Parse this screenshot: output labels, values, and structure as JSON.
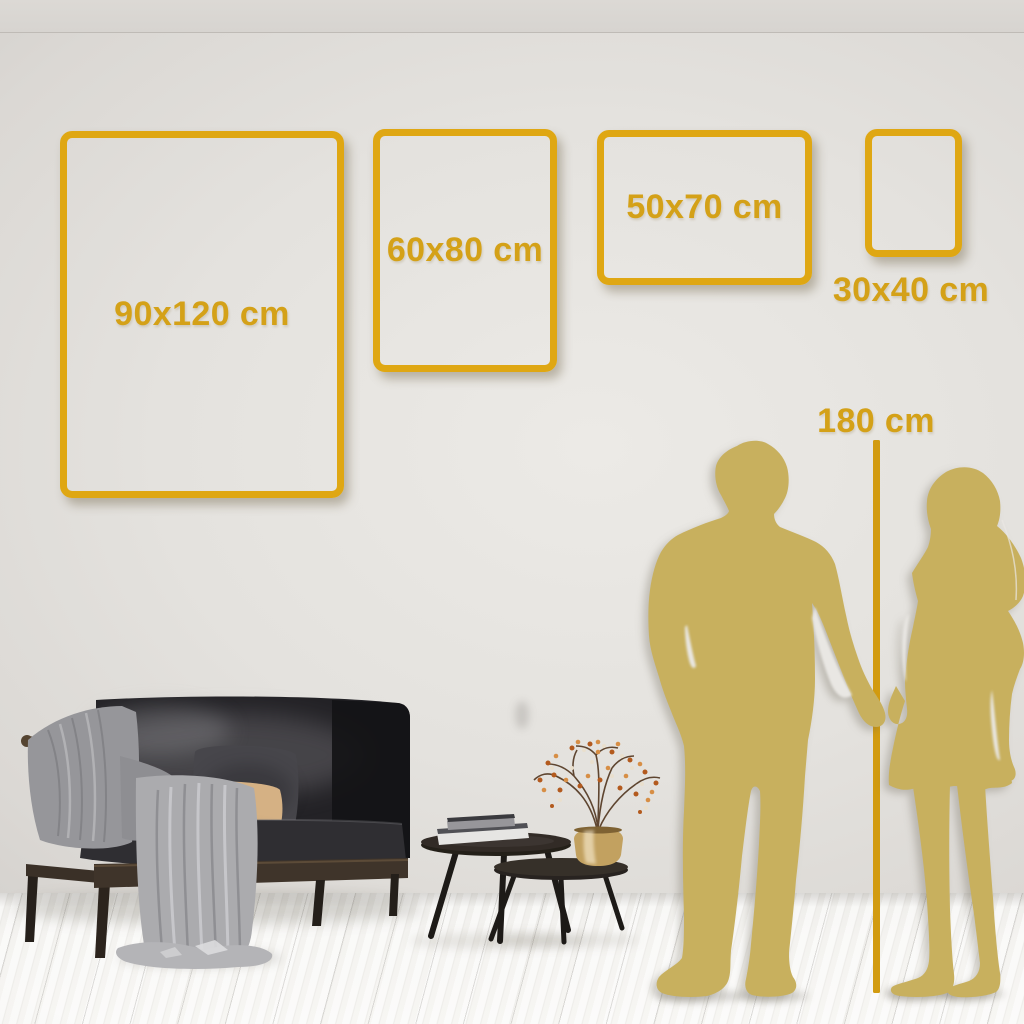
{
  "size_guide": {
    "unit": "cm",
    "frames": [
      {
        "label": "90x120 cm",
        "width_cm": 90,
        "height_cm": 120,
        "orientation_shown": "portrait"
      },
      {
        "label": "60x80 cm",
        "width_cm": 60,
        "height_cm": 80,
        "orientation_shown": "portrait"
      },
      {
        "label": "50x70 cm",
        "width_cm": 50,
        "height_cm": 70,
        "orientation_shown": "landscape"
      },
      {
        "label": "30x40 cm",
        "width_cm": 30,
        "height_cm": 40,
        "orientation_shown": "portrait"
      }
    ],
    "height_reference": {
      "label": "180 cm",
      "value_cm": 180,
      "subject": "couple silhouette with vertical measuring line"
    }
  },
  "palette": {
    "gold_frame": "#DFA713",
    "gold_text": "#D4A118",
    "gold_line": "#D29B10",
    "gold_silhouette": "#C8B05E",
    "wall": "#E4E2DE",
    "floor": "#F4F3F0"
  },
  "scene": {
    "figures": [
      "man-silhouette",
      "woman-silhouette"
    ],
    "furniture": [
      "dark-velvet-sofa",
      "gray-throw-blanket",
      "beige-pillow",
      "dark-pillow",
      "nesting-coffee-tables",
      "books-stack",
      "brass-vase",
      "dried-berry-branches"
    ],
    "room": [
      "wall",
      "ceiling-line",
      "whitewashed-wood-floor"
    ]
  }
}
